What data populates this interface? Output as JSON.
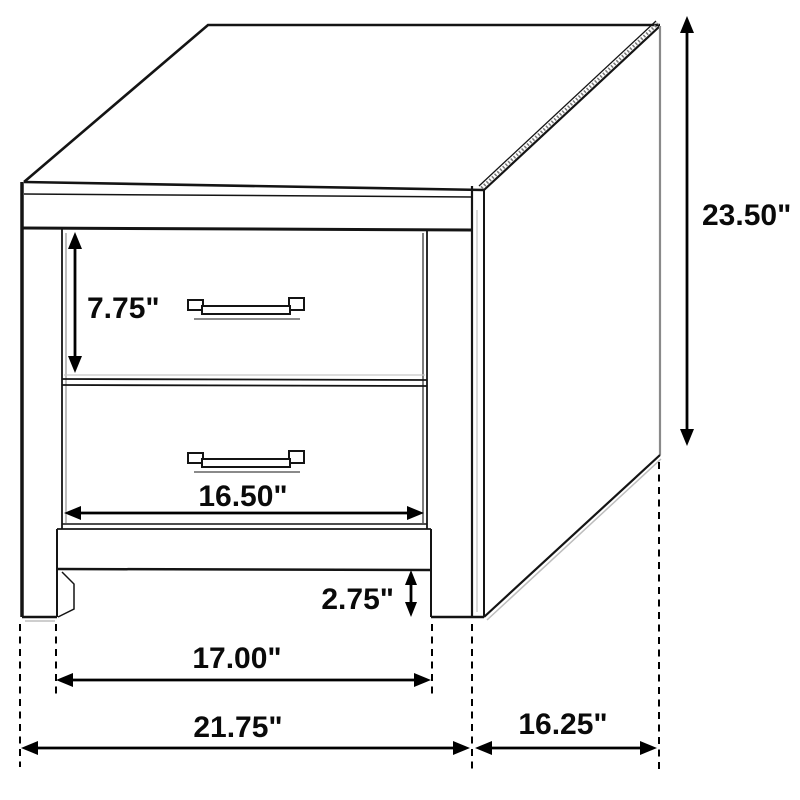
{
  "colors": {
    "background": "#ffffff",
    "ink": "#141414",
    "shadow": "#8a8a8a"
  },
  "dims": {
    "drawer_height": {
      "label": "7.75\""
    },
    "drawer_width": {
      "label": "16.50\""
    },
    "leg_height": {
      "label": "2.75\""
    },
    "leg_span": {
      "label": "17.00\""
    },
    "overall_width": {
      "label": "21.75\""
    },
    "depth": {
      "label": "16.25\""
    },
    "overall_height": {
      "label": "23.50\""
    }
  }
}
